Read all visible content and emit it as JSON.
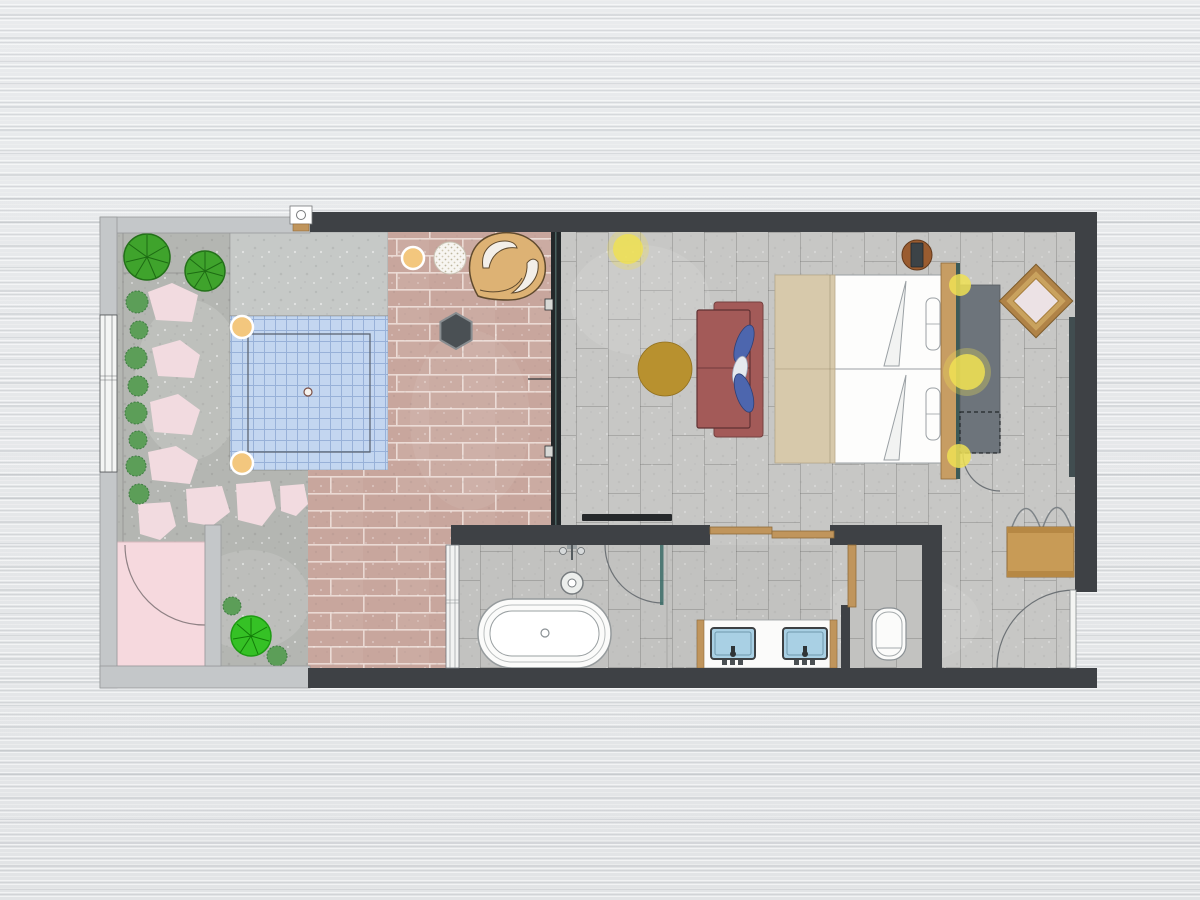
{
  "meta": {
    "title": "Hotel suite floor plan",
    "type": "architectural-floor-plan",
    "canvas": {
      "width": 1200,
      "height": 900
    }
  },
  "colors": {
    "wall_dark": "#3e4145",
    "wall_light": "#c4c7c9",
    "terrace_concrete": "#b4b6b2",
    "pool_deck_slab": "#c6c9c7",
    "pool_water": "#c3d6f0",
    "deck_brick": "#c8a69d",
    "bedroom_tile": "#c7c7c5",
    "bath_tile": "#c2c2c0",
    "glass_dark": "#23282a",
    "stepping_stone": "#f2dbe0",
    "pink_room": "#f6d9de",
    "gate_white": "#f4f5f4",
    "tree_green": "#3fa32c",
    "tree_bright": "#35c125",
    "shrub_green": "#5c9e58",
    "sofa_red": "#a35a58",
    "pillow_blue": "#4d66ae",
    "pillow_white": "#e6e9ee",
    "coffee_gold": "#b8912f",
    "ceiling_light": "#efe054",
    "stool_peach": "#f3c77e",
    "lounge_tan": "#ddb274",
    "hex_charcoal": "#4a5054",
    "side_table_brown": "#9a5c30",
    "tray_slate": "#3c4347",
    "bed_white": "#fdfdfc",
    "blanket_beige": "#d7c9ab",
    "headboard_wood": "#c79d63",
    "headboard_teal": "#3c5a57",
    "wardrobe_gray": "#6d747b",
    "mirror_frame": "#b08347",
    "mirror_frame_light": "#c9a25e",
    "mirror_face": "#ece2e5",
    "panel_teal": "#414d50",
    "wood_trim": "#c0955c",
    "bench_wood": "#c89b56",
    "sink_blue": "#a9d0e4",
    "fixture_white": "#fbfbfa",
    "tv_black": "#26292b",
    "rattan_table": "#f7f5f1",
    "background": "#e7e9eb"
  },
  "elements": {
    "outdoor": [
      "terrace",
      "plunge-pool",
      "pool-deck",
      "timber-deck",
      "stepping-stones",
      "trees",
      "shrubs",
      "lounge-chair",
      "rattan-table",
      "pool-stools",
      "outdoor-shower-room",
      "garden-gate"
    ],
    "bedroom": [
      "twin-bed-1",
      "twin-bed-2",
      "headboard",
      "sofa",
      "coffee-table",
      "bedside-table",
      "wardrobe",
      "diamond-mirror",
      "luggage-bench",
      "tv",
      "ceiling-lights",
      "closet-door",
      "entry-door",
      "wall-panel"
    ],
    "bathroom": [
      "bathtub",
      "tub-filler",
      "shower-door",
      "double-vanity",
      "sink-left",
      "sink-right",
      "toilet",
      "window",
      "sliding-wood-doors"
    ]
  }
}
